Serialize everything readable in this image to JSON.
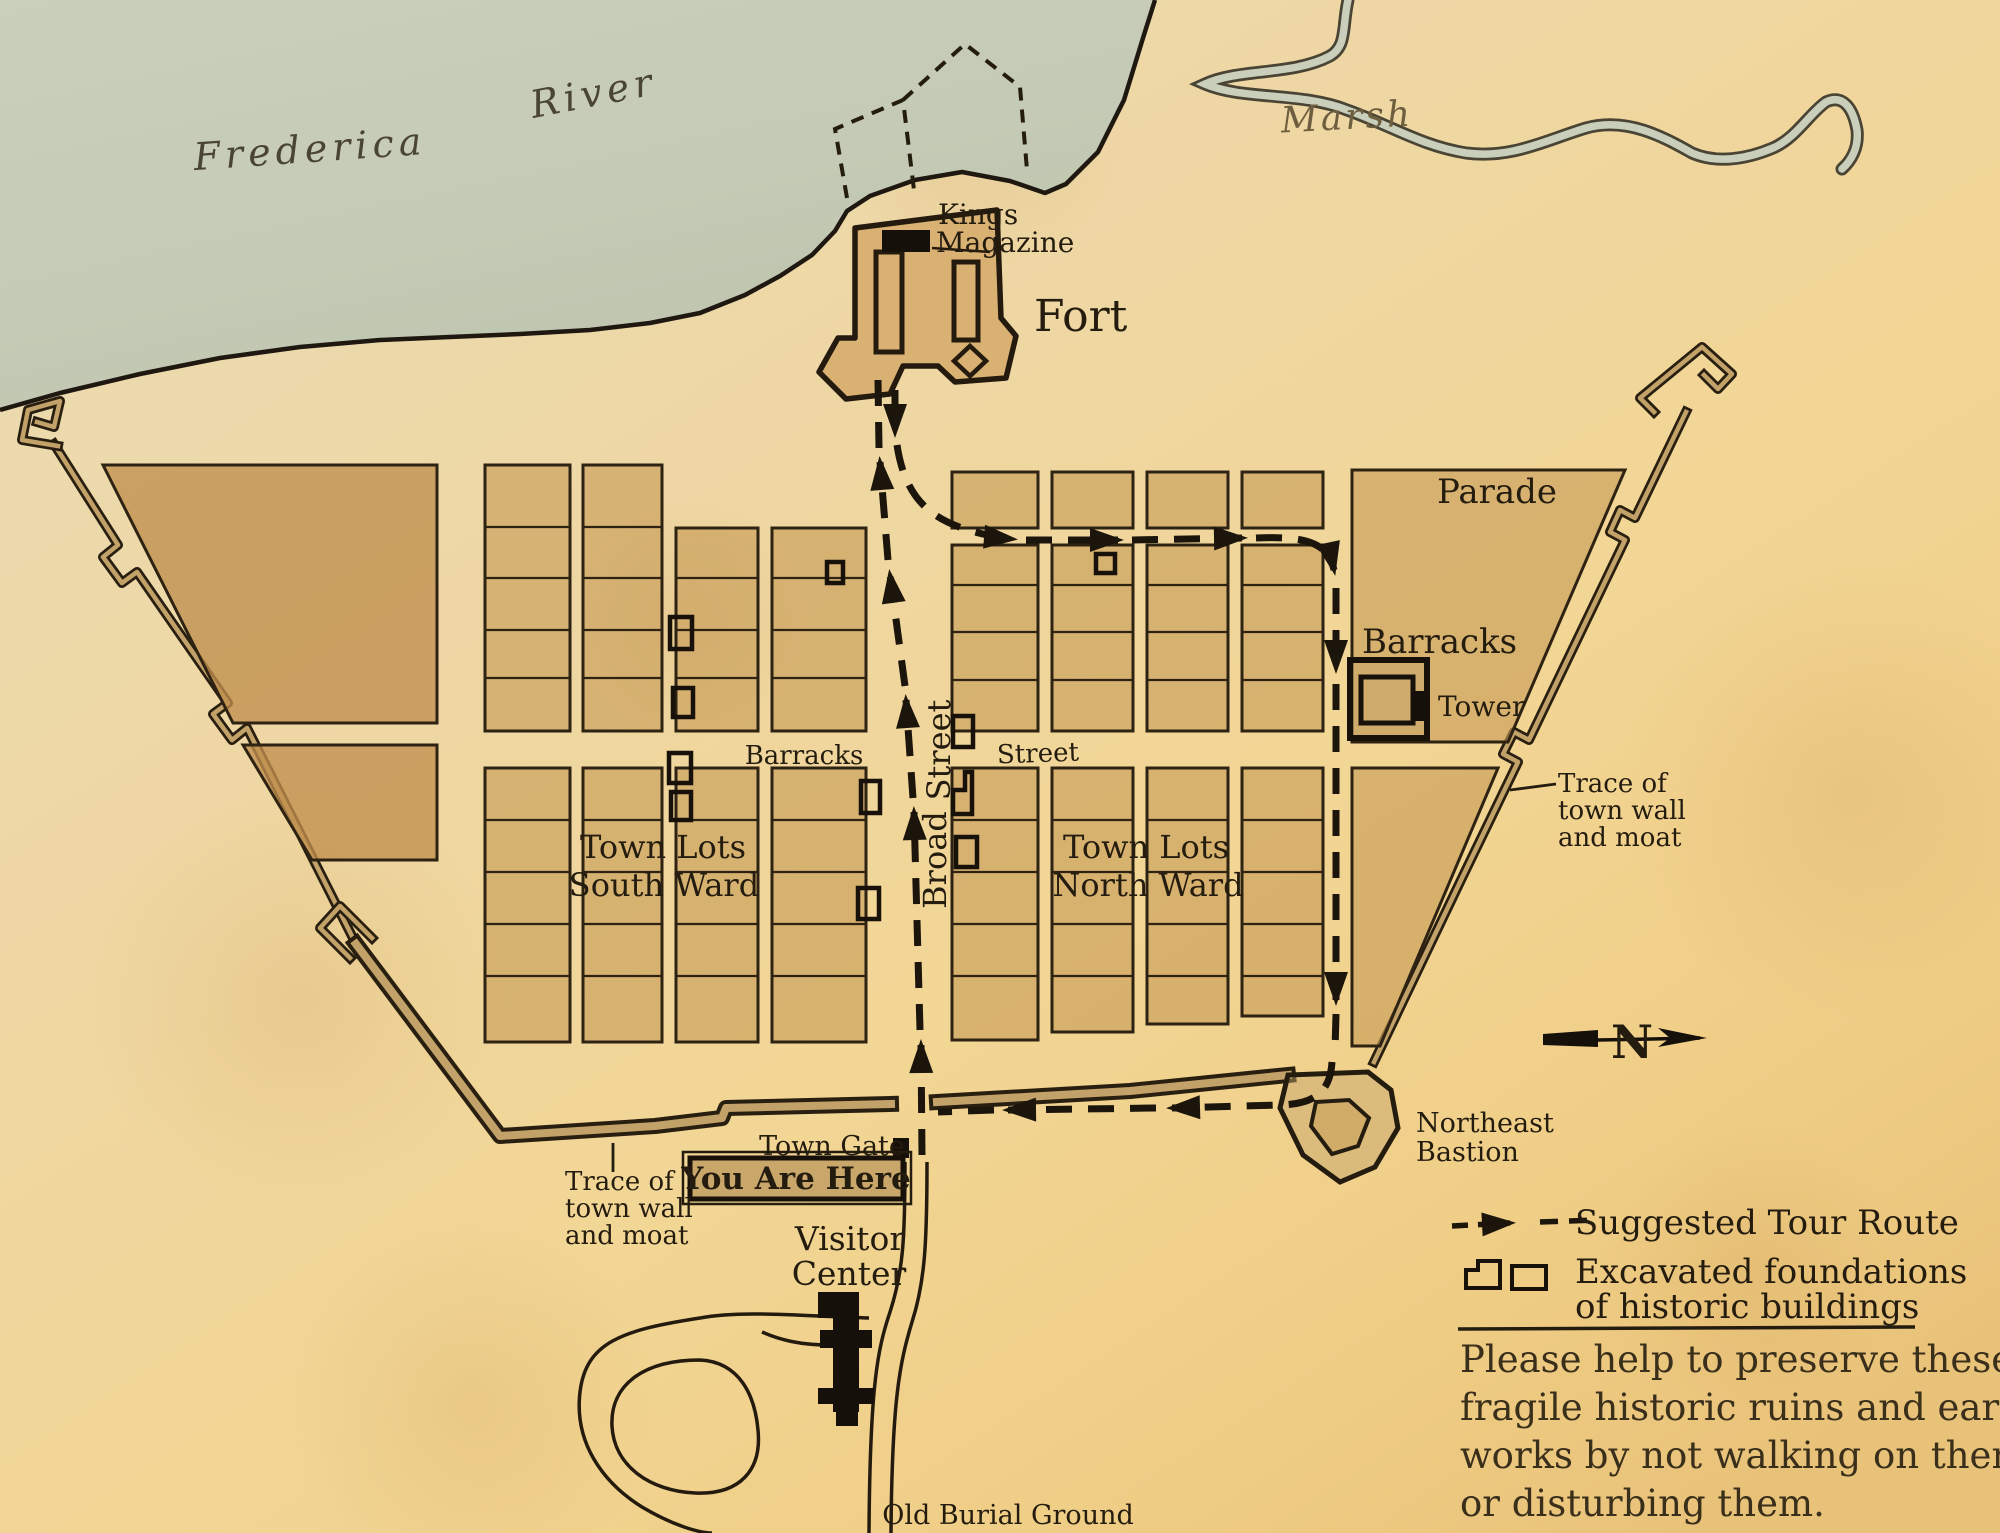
{
  "water": {
    "frederica": "Frederica",
    "river": "River",
    "marsh": "Marsh"
  },
  "fort": {
    "label": "Fort",
    "kings": "Kings",
    "magazine": "Magazine"
  },
  "town": {
    "parade": "Parade",
    "barracks_building": "Barracks",
    "tower": "Tower",
    "broad": "Broad",
    "broad_word_street": "Street",
    "barracks_street_west": "Barracks",
    "barracks_street_east": "Street",
    "south_ward_line1": "Town Lots",
    "south_ward_line2": "South Ward",
    "north_ward_line1": "Town Lots",
    "north_ward_line2": "North Ward",
    "trace_right": [
      "Trace of",
      "town wall",
      "and moat"
    ],
    "trace_left": [
      "Trace of",
      "town wall",
      "and moat"
    ],
    "town_gate": "Town Gate",
    "you_are_here": "You Are Here",
    "visitor_line1": "Visitor",
    "visitor_line2": "Center",
    "old_burial_ground": "Old Burial Ground",
    "northeast_line1": "Northeast",
    "northeast_line2": "Bastion",
    "north_letter": "N"
  },
  "legend": {
    "tour_route": "Suggested Tour Route",
    "foundations_line1": "Excavated foundations",
    "foundations_line2": "of historic buildings"
  },
  "notice": {
    "lines": [
      "Please help to preserve these",
      "fragile historic ruins and earth-",
      "works by not walking on them",
      "or disturbing them."
    ]
  },
  "colors": {
    "water": "#c6ccb7",
    "parchment": "#efd49c",
    "block_fill": "#c79b56",
    "wall_core": "#c2a269",
    "ink": "#241c0f",
    "black_building": "#16100a"
  },
  "icons": {
    "north_arrow": "north-arrow",
    "tour_route_arrow": "dashed-arrow",
    "foundation_symbols": "building-outline"
  }
}
